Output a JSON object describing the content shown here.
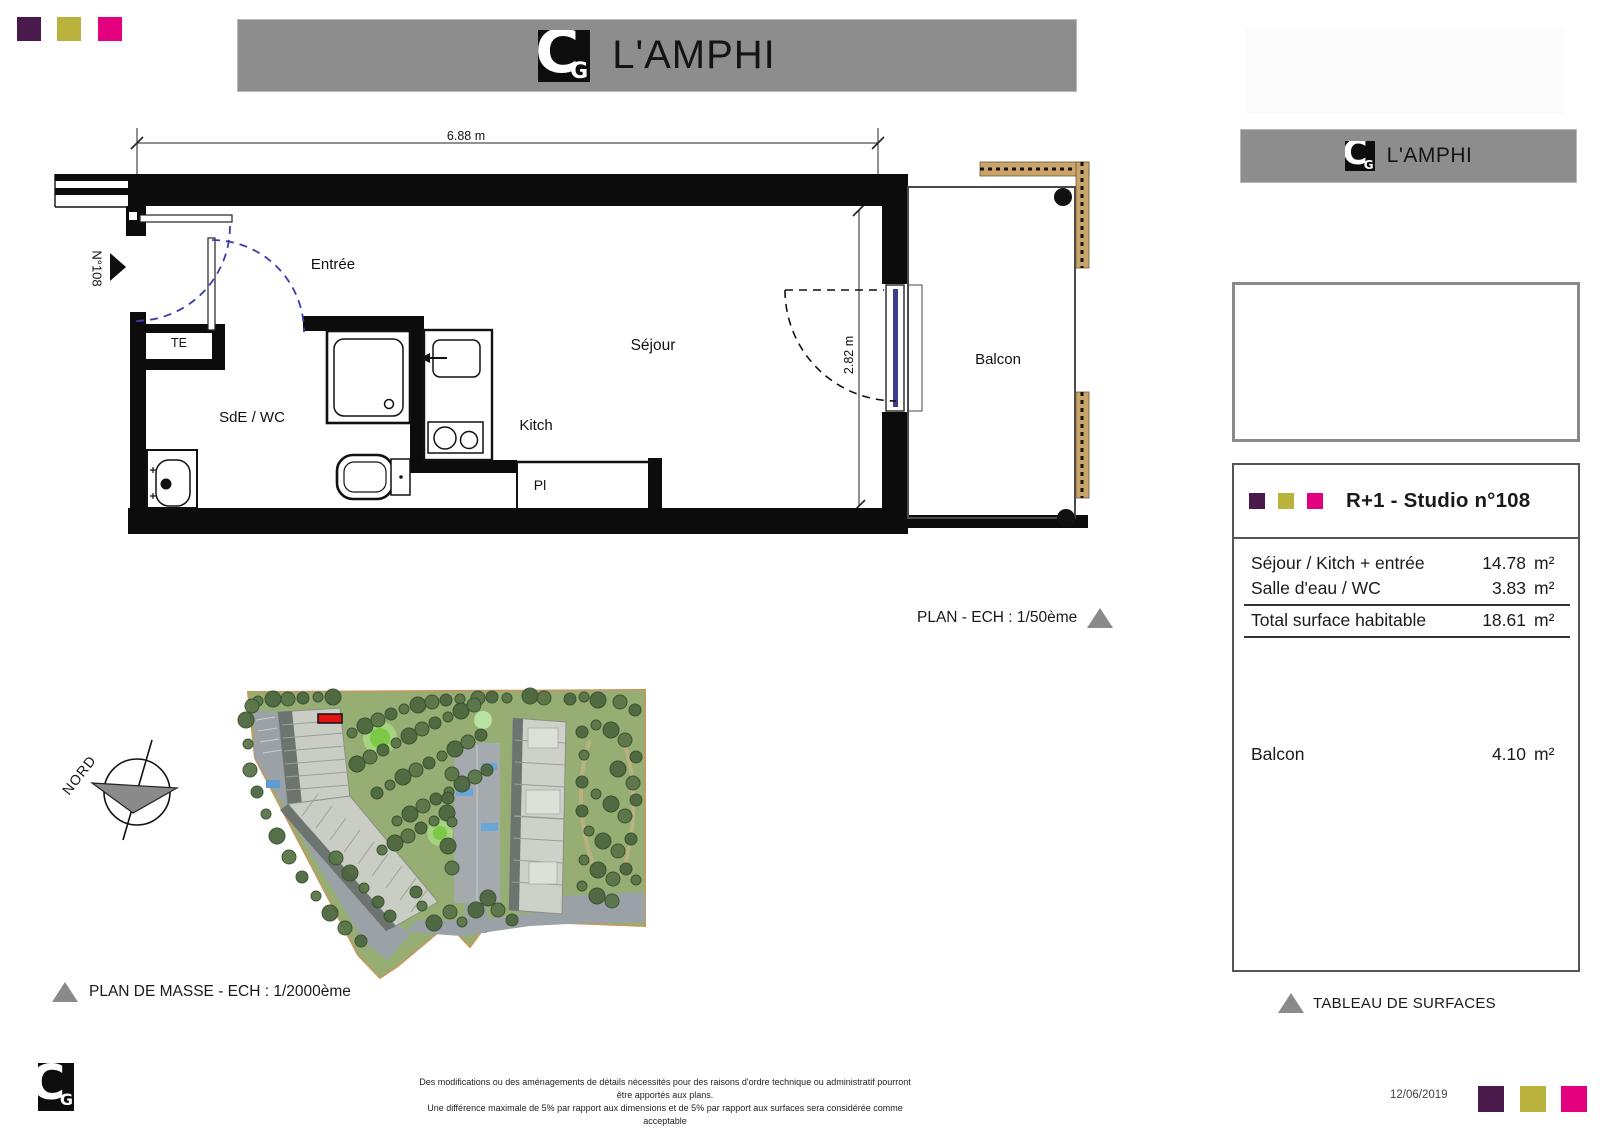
{
  "brand": {
    "title": "L'AMPHI",
    "logo": {
      "c": "C",
      "g": "G"
    },
    "palette": [
      "#4a1a4d",
      "#b9b23d",
      "#e2007e"
    ],
    "banner_gray": "#8d8d8d"
  },
  "header": {
    "title": "L'AMPHI"
  },
  "side_banner": {
    "title": "L'AMPHI"
  },
  "floor_plan": {
    "width_dim": "6.88 m",
    "height_dim": "2.82 m",
    "unit_number": "N°108",
    "labels": {
      "entree": "Entrée",
      "sejour": "Séjour",
      "sde_wc": "SdE / WC",
      "kitch": "Kitch",
      "balcon": "Balcon",
      "placard": "Pl",
      "te": "TE"
    },
    "caption": "PLAN - ECH : 1/50ème"
  },
  "site_plan": {
    "north": "NORD",
    "caption": "PLAN DE MASSE - ECH : 1/2000ème",
    "marker_color": "#e51414"
  },
  "surface_table": {
    "title": "R+1 - Studio n°108",
    "caption": "TABLEAU DE SURFACES",
    "rows": [
      {
        "label": "Séjour / Kitch + entrée",
        "value": "14.78",
        "unit": "m²"
      },
      {
        "label": "Salle d'eau / WC",
        "value": "3.83",
        "unit": "m²"
      }
    ],
    "total_row": {
      "label": "Total surface habitable",
      "value": "18.61",
      "unit": "m²"
    },
    "balcony_row": {
      "label": "Balcon",
      "value": "4.10",
      "unit": "m²"
    }
  },
  "footer": {
    "disclaimer1": "Des modifications ou des aménagements de détails nécessités pour des raisons d'ordre technique ou administratif pourront être apportés aux plans.",
    "disclaimer2": "Une différence maximale de 5% par rapport aux dimensions et de 5% par rapport aux surfaces sera considérée comme acceptable",
    "date": "12/06/2019"
  }
}
